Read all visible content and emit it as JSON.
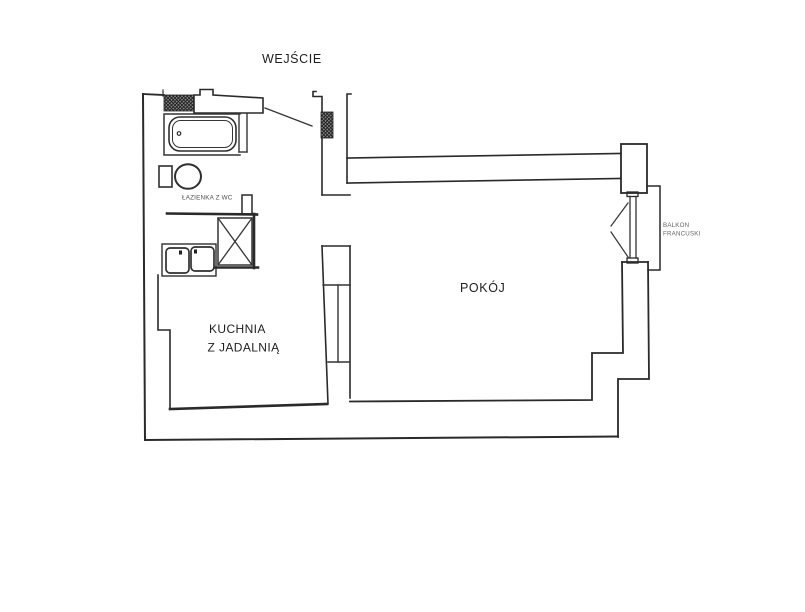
{
  "plan": {
    "type": "apartment-floor-plan",
    "labels": {
      "entrance": "WEJŚCIE",
      "bathroom": "ŁAZIENKA Z WC",
      "kitchen_line1": "KUCHNIA",
      "kitchen_line2": "Z JADALNIĄ",
      "room": "POKÓJ",
      "balcony_line1": "BALKON",
      "balcony_line2": "FRANCUSKI"
    },
    "fixtures": [
      "bathtub",
      "toilet",
      "double-kitchen-sink",
      "ventilation-shaft",
      "entrance-door-swing",
      "french-window-swing",
      "balcony-rail"
    ],
    "colors": {
      "background": "#ffffff",
      "wall_line": "#2a2a2a",
      "muted_label": "#666666",
      "bathroom_label": "#4d4d4d",
      "wall_hatch_fill": "#8b8b8b",
      "wall_hatch_line": "#1c1c1c"
    }
  }
}
